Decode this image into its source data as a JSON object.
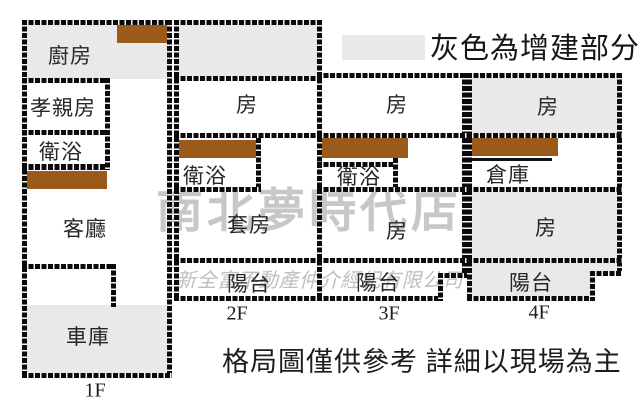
{
  "legend": {
    "label": "灰色為增建部分",
    "swatch_color": "#e9e9e9"
  },
  "disclaimer": "格局圖僅供參考 詳細以現場為主",
  "watermarks": {
    "store": "南北夢時代店",
    "company": "新全富不動產仲介經紀有限公司"
  },
  "colors": {
    "extension_gray": "#e9e9e9",
    "cabinet_brown": "#9a5a1a",
    "wall_black": "#0b0b0b",
    "watermark_gray": "#c7c7c7"
  },
  "floors": [
    {
      "label": "1F",
      "rooms": [
        "廚房",
        "孝親房",
        "衛浴",
        "客廳",
        "車庫"
      ]
    },
    {
      "label": "2F",
      "rooms": [
        "房",
        "衛浴",
        "套房",
        "陽台"
      ]
    },
    {
      "label": "3F",
      "rooms": [
        "房",
        "衛浴",
        "房",
        "陽台"
      ]
    },
    {
      "label": "4F",
      "rooms": [
        "房",
        "倉庫",
        "房",
        "陽台"
      ]
    }
  ]
}
